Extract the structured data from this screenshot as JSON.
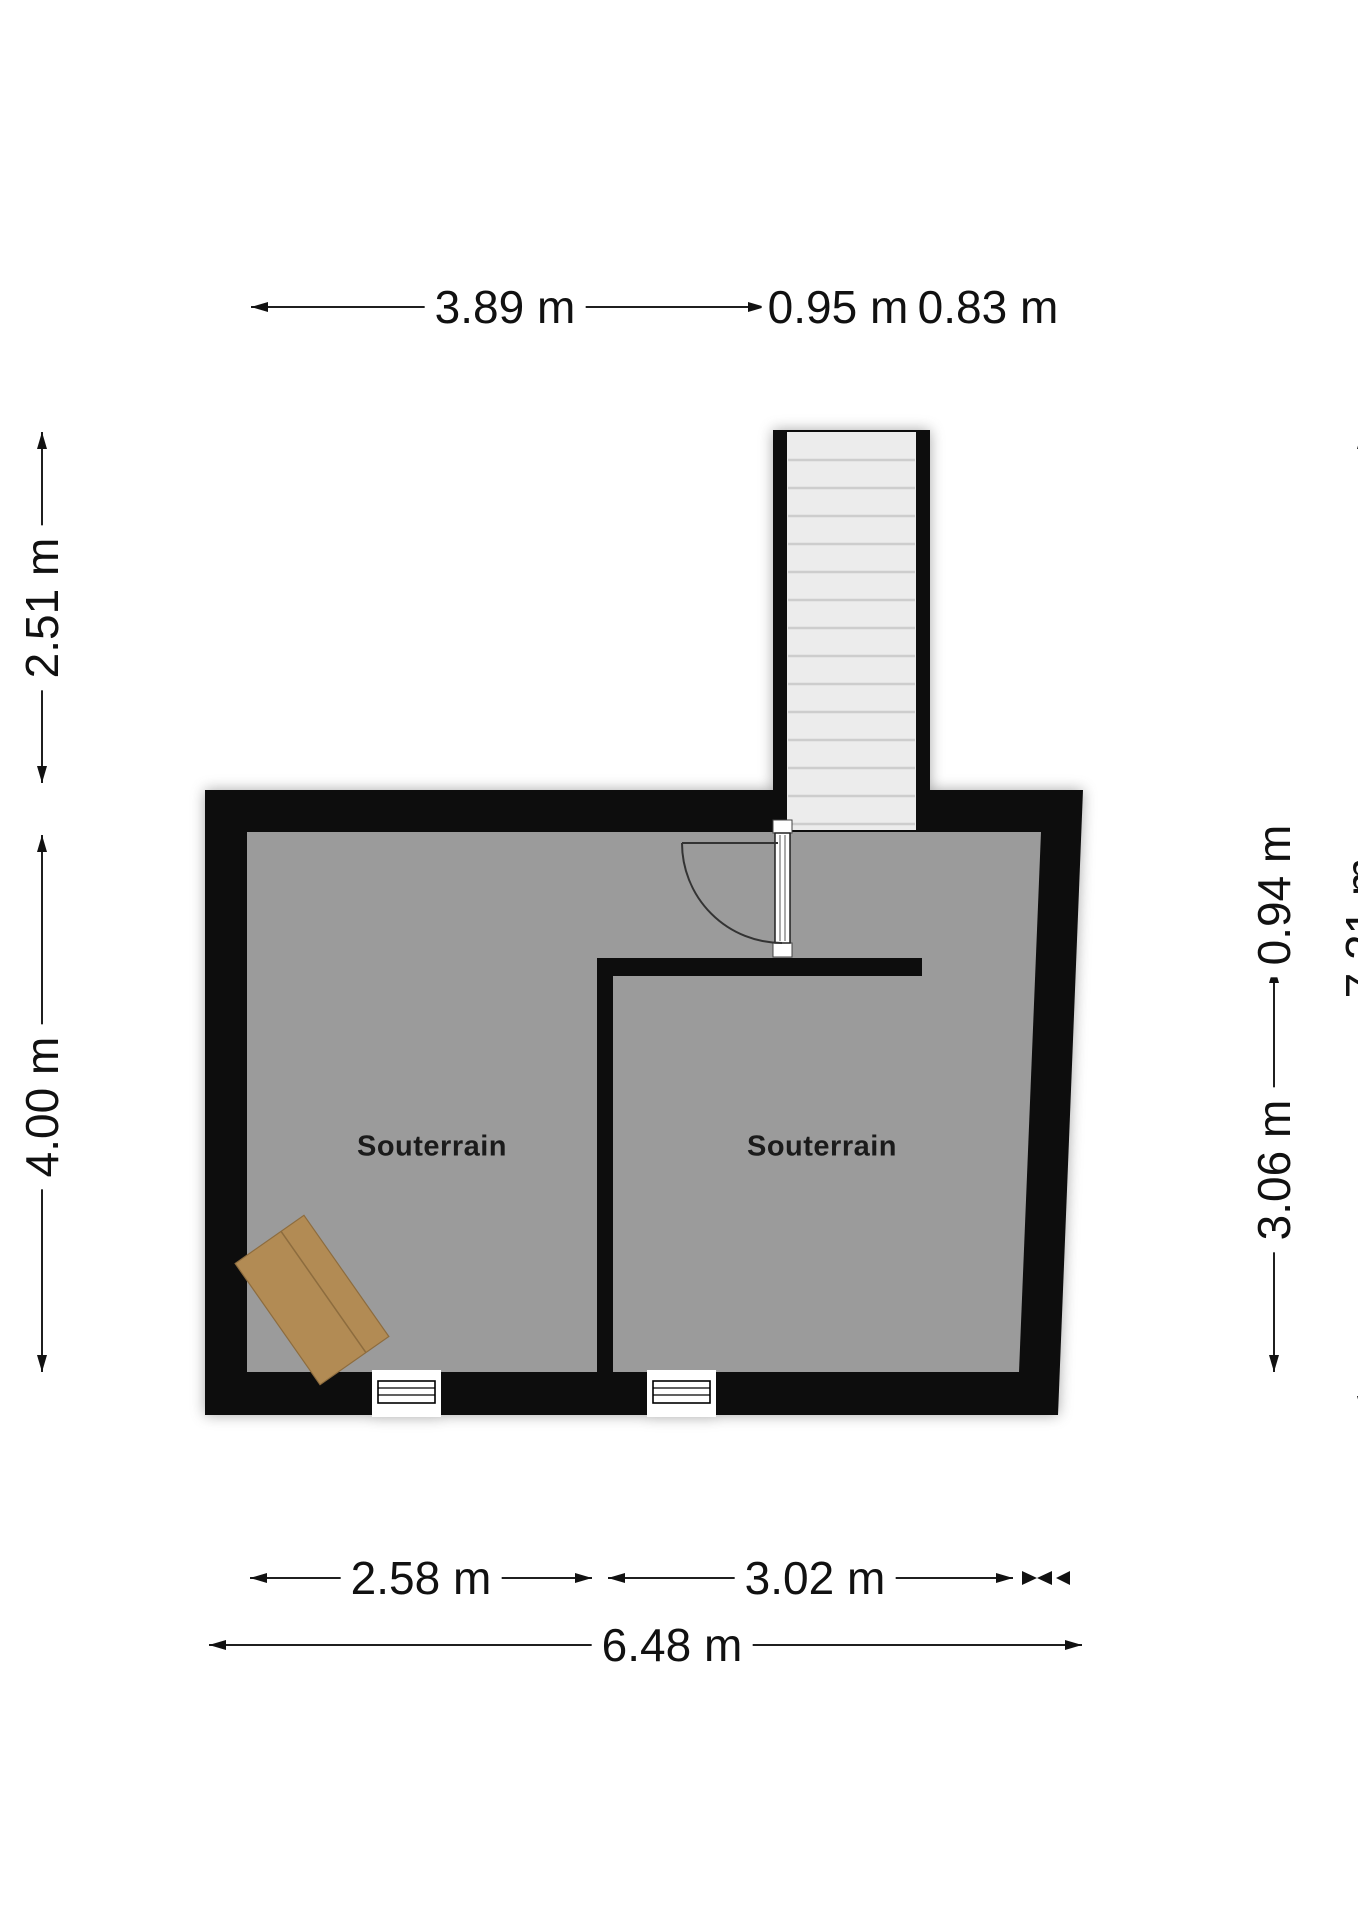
{
  "floorplan": {
    "rooms": [
      {
        "label": "Souterrain"
      },
      {
        "label": "Souterrain"
      }
    ],
    "dimensions": {
      "top": [
        {
          "label": "3.89 m"
        },
        {
          "label": "0.95 m"
        },
        {
          "label": "0.83 m"
        }
      ],
      "left": [
        {
          "label": "2.51 m"
        },
        {
          "label": "4.00 m"
        }
      ],
      "right": [
        {
          "label": "0.94 m"
        },
        {
          "label": "3.06 m"
        },
        {
          "label": "7.21 m"
        }
      ],
      "bottom": [
        {
          "label": "2.58 m"
        },
        {
          "label": "3.02 m"
        },
        {
          "label": "6.48 m"
        }
      ]
    },
    "colors": {
      "wall": "#0d0d0d",
      "floor": "#9b9b9b",
      "stair_tread": "#ececec",
      "stair_tread_line": "#cdcdcd",
      "rug": "#b28b54",
      "rug_line": "#8d6c3e",
      "dimension_line": "#1f1f1f"
    }
  }
}
